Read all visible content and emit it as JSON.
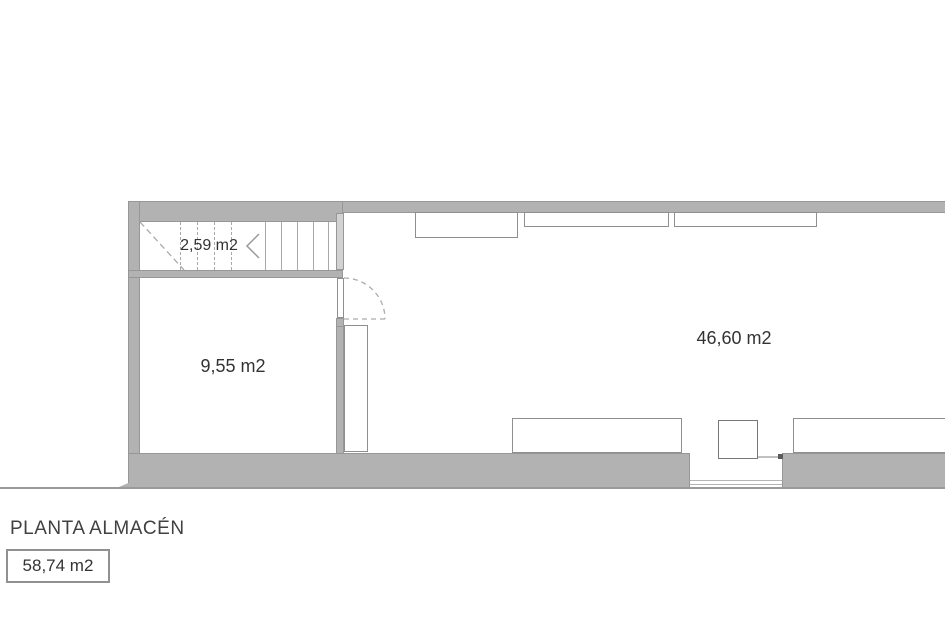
{
  "plan": {
    "title": "PLANTA ALMACÉN",
    "total_area_label": "58,74 m2",
    "areas": {
      "staircase": "2,59 m2",
      "storage_room": "9,55 m2",
      "main_room": "46,60 m2"
    }
  },
  "colors": {
    "wall_fill": "#b2b2b2",
    "wall_edge": "#979797",
    "drawing_line": "#9a9a9a",
    "text": "#3d3d3d",
    "background": "#ffffff"
  }
}
